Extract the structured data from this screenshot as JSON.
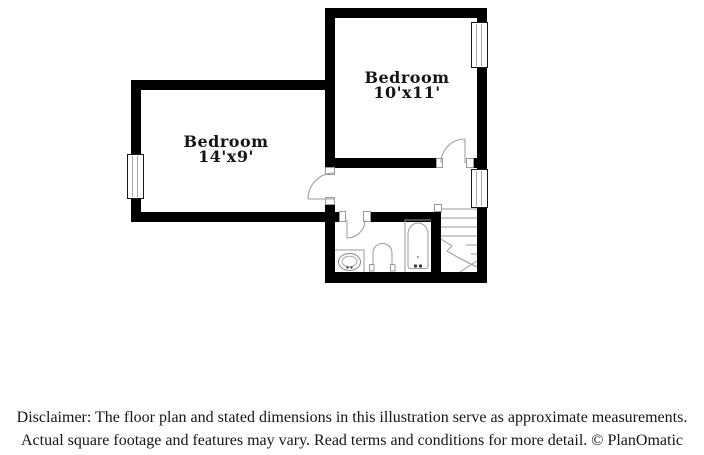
{
  "title": "Floor plan illustration",
  "rooms": [
    {
      "name": "Bedroom",
      "dims": "14'x9'"
    },
    {
      "name": "Bedroom",
      "dims": "10'x11'"
    }
  ],
  "fixtures": [
    "bathtub",
    "toilet",
    "sink",
    "vanity",
    "staircase"
  ],
  "symbols": {
    "windows": 3,
    "doors": 3
  },
  "disclaimer": {
    "line1": "Disclaimer: The floor plan and stated dimensions in this illustration serve as approximate measurements.",
    "line2": "Actual square footage and features may vary. Read terms and conditions for more detail. © PlanOmatic"
  },
  "colors": {
    "wall": "#000000",
    "fixture_line": "#999999",
    "text": "#151515",
    "background": "#ffffff"
  }
}
